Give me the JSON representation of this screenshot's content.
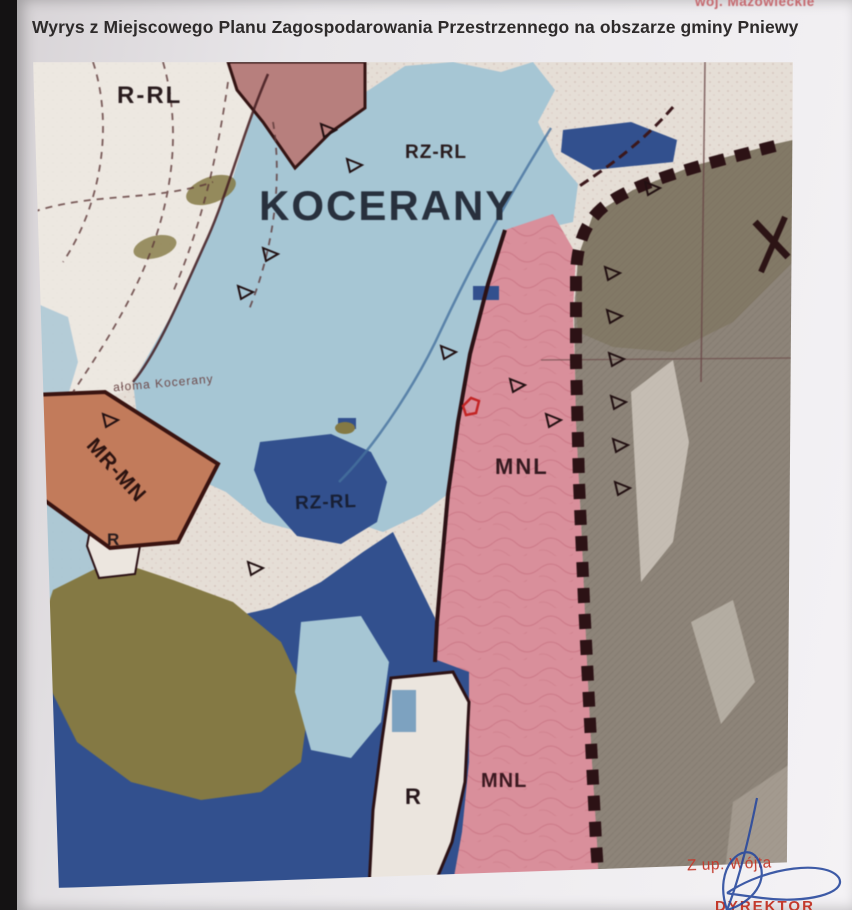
{
  "page": {
    "corner_note": "woj. Mazowieckie",
    "title": "Wyrys z Miejscowego Planu Zagospodarowania Przestrzennego na obszarze gminy Pniewy"
  },
  "map": {
    "labels": [
      {
        "id": "r-rl",
        "text": "R-RL"
      },
      {
        "id": "rz-rl-top",
        "text": "RZ-RL"
      },
      {
        "id": "kocerany",
        "text": "KOCERANY"
      },
      {
        "id": "place-small",
        "text": "ałoma Kocerany"
      },
      {
        "id": "mr-mn",
        "text": "MR-MN"
      },
      {
        "id": "r-left",
        "text": "R"
      },
      {
        "id": "rz-rl-center",
        "text": "RZ-RL"
      },
      {
        "id": "mnl-right",
        "text": "MNL"
      },
      {
        "id": "mnl-bottom",
        "text": "MNL"
      },
      {
        "id": "r-bottom",
        "text": "R"
      }
    ],
    "zones": {
      "cream": "#e9e1d8",
      "light_blue": "#a6c8d8",
      "dark_blue": "#2e4f92",
      "pink": "#df8f9c",
      "dusty_red": "#bb7e7c",
      "orange": "#c77a57",
      "olive": "#85793f",
      "gray": "#8e8478",
      "boundary": "#2b0e12",
      "scribble": "#c25b6e"
    }
  },
  "signature": {
    "line1": "Z up. Wójta",
    "line2": "DYREKTOR",
    "ink_color": "#2a4a9e",
    "text_color": "#c33a2c"
  }
}
